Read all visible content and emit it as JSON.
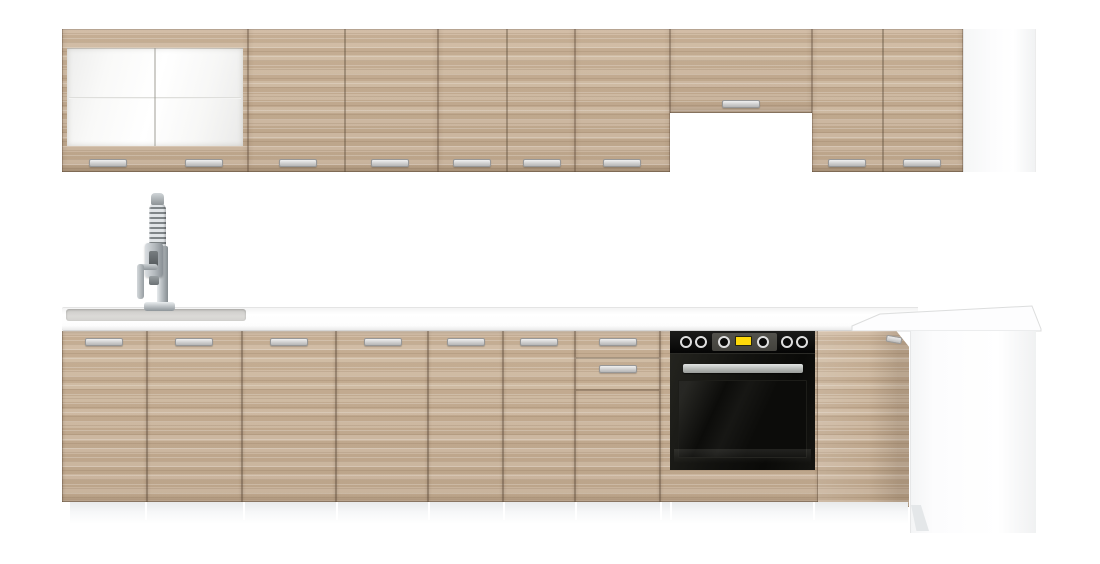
{
  "meta": {
    "canvas_w": 1100,
    "canvas_h": 564,
    "description": "Product render of a modular kitchen set: light sonoma-oak fronts, white worktop, glass-front wall cabinet, cooker-hood recess, built-in black oven, inset sink with tall spring mixer tap, white end panels"
  },
  "colors": {
    "background": "#ffffff",
    "wood_base": "#c8b198",
    "wood_light": "#d7c3ab",
    "wood_dark": "#b49c82",
    "gap_line": "rgba(88,70,52,0.38)",
    "handle_face": "#d9d9d9",
    "handle_edge": "#979797",
    "counter_white": "#fdfdfd",
    "counter_shadow": "#d6d6d6",
    "sink_gray": "#d6d5d2",
    "oven_black": "#0d0d0b",
    "oven_inset_gray": "#4a4944",
    "oven_display_yellow": "#ffd90a",
    "oven_handle_silver": "#c7c9c6",
    "chrome": "#aeb4b8",
    "panel_white": "#f8f9f9",
    "plinth_gray": "#e9ebec"
  },
  "wall_row": {
    "top": 29,
    "height": 143,
    "units": [
      {
        "kind": "glass",
        "name": "wall-cabinet-glass",
        "x": 62,
        "w": 186,
        "divider_cx": 155,
        "handles": [
          108,
          204
        ],
        "glass": {
          "inset_x": 5,
          "top": 19,
          "height": 98
        }
      },
      {
        "kind": "doors",
        "name": "wall-cabinet-2door",
        "x": 248,
        "w": 190,
        "dividers": [
          345
        ],
        "handles": [
          298,
          390
        ]
      },
      {
        "kind": "doors",
        "name": "wall-cabinet-2door",
        "x": 438,
        "w": 137,
        "dividers": [
          507
        ],
        "handles": [
          472,
          542
        ]
      },
      {
        "kind": "doors",
        "name": "wall-cabinet-1door",
        "x": 575,
        "w": 95,
        "dividers": [],
        "handles": [
          622
        ]
      },
      {
        "kind": "hood",
        "name": "wall-cabinet-hood",
        "x": 670,
        "w": 142,
        "h": 84,
        "handles": [
          741
        ]
      },
      {
        "kind": "doors",
        "name": "wall-cabinet-2door",
        "x": 812,
        "w": 151,
        "dividers": [
          883
        ],
        "handles": [
          847,
          922
        ]
      },
      {
        "kind": "panel",
        "name": "wall-end-panel",
        "x": 963,
        "w": 73
      }
    ]
  },
  "base_row": {
    "top": 331,
    "height": 171,
    "handle_top": 7,
    "units": [
      {
        "kind": "doors",
        "name": "base-cabinet-door",
        "x": 62,
        "w": 85,
        "handles": [
          104
        ]
      },
      {
        "kind": "doors",
        "name": "base-cabinet-door",
        "x": 147,
        "w": 95,
        "handles": [
          194
        ]
      },
      {
        "kind": "doors",
        "name": "base-cabinet-door",
        "x": 242,
        "w": 94,
        "handles": [
          289
        ]
      },
      {
        "kind": "doors",
        "name": "base-cabinet-door",
        "x": 336,
        "w": 92,
        "handles": [
          383
        ]
      },
      {
        "kind": "doors",
        "name": "base-cabinet-door",
        "x": 428,
        "w": 75,
        "handles": [
          466
        ]
      },
      {
        "kind": "doors",
        "name": "base-cabinet-door",
        "x": 503,
        "w": 72,
        "handles": [
          539
        ]
      },
      {
        "kind": "drawers",
        "name": "base-drawer-unit",
        "x": 575,
        "w": 85,
        "fronts": [
          {
            "h": 27,
            "handle": true
          },
          {
            "h": 32,
            "handle": true
          },
          {
            "h": 112,
            "handle": false
          }
        ]
      },
      {
        "kind": "housing",
        "name": "oven-housing",
        "x": 660,
        "w": 158
      },
      {
        "kind": "corner",
        "name": "corner-base-cabinet",
        "x": 818,
        "w": 91,
        "h": 176,
        "clip": "polygon(0% 0%, 86% 0%, 100% 9%, 100% 100%, 0% 97%)",
        "handle": {
          "x": 886,
          "y": 336
        }
      },
      {
        "kind": "endpanel",
        "name": "base-end-panel",
        "x": 910,
        "w": 126,
        "h": 202
      }
    ]
  },
  "countertop": {
    "main": {
      "x": 62,
      "y": 307,
      "w": 856,
      "h": 24
    },
    "sink": {
      "x": 66,
      "y": 309,
      "w": 180,
      "h": 12
    },
    "corner_points": "852,326 880,314 1032,306 1041,329 1041,331 852,331"
  },
  "plinth": {
    "x": 70,
    "y": 502,
    "w": 838,
    "h": 22,
    "gaps": [
      145,
      243,
      336,
      428,
      503,
      575,
      660,
      670,
      813
    ]
  },
  "oven": {
    "x": 670,
    "y": 331,
    "w": 145,
    "h": 139,
    "panel_h": 22,
    "knobs": [
      686,
      701,
      724,
      763,
      787,
      802
    ],
    "knob_cy": 342,
    "inset": {
      "x": 712,
      "w": 65,
      "y": 333,
      "h": 18
    },
    "display": {
      "x": 735,
      "w": 17,
      "y": 336,
      "h": 10
    },
    "door": {
      "y": 353,
      "h": 117
    },
    "glass": {
      "x": 678,
      "w": 129,
      "y": 379,
      "h": 78
    },
    "handle": {
      "x": 683,
      "w": 120,
      "y": 363,
      "h": 9
    },
    "sheen": {
      "y": 448,
      "h": 14
    }
  },
  "faucet": {
    "parts": [
      {
        "cls": "f-spring",
        "name": "faucet-spring-coil",
        "x": 149,
        "y": 202,
        "w": 17,
        "h": 52
      },
      {
        "cls": "f-cap",
        "name": "faucet-top-cap",
        "x": 151,
        "y": 193,
        "w": 13,
        "h": 12
      },
      {
        "cls": "f-column",
        "name": "faucet-body",
        "x": 157,
        "y": 246,
        "w": 11,
        "h": 60
      },
      {
        "cls": "f-head",
        "name": "faucet-spray-head",
        "x": 145,
        "y": 243,
        "w": 18,
        "h": 34
      },
      {
        "cls": "f-slot",
        "name": "faucet-head-slot",
        "x": 149,
        "y": 251,
        "w": 9,
        "h": 17
      },
      {
        "cls": "f-nozzle",
        "name": "faucet-nozzle",
        "x": 149,
        "y": 276,
        "w": 10,
        "h": 9
      },
      {
        "cls": "f-lever-h",
        "name": "faucet-lever-arm",
        "x": 140,
        "y": 264,
        "w": 18,
        "h": 6
      },
      {
        "cls": "f-lever-v",
        "name": "faucet-lever",
        "x": 137,
        "y": 264,
        "w": 7,
        "h": 35
      },
      {
        "cls": "f-base",
        "name": "faucet-base",
        "x": 144,
        "y": 302,
        "w": 31,
        "h": 9
      }
    ]
  }
}
